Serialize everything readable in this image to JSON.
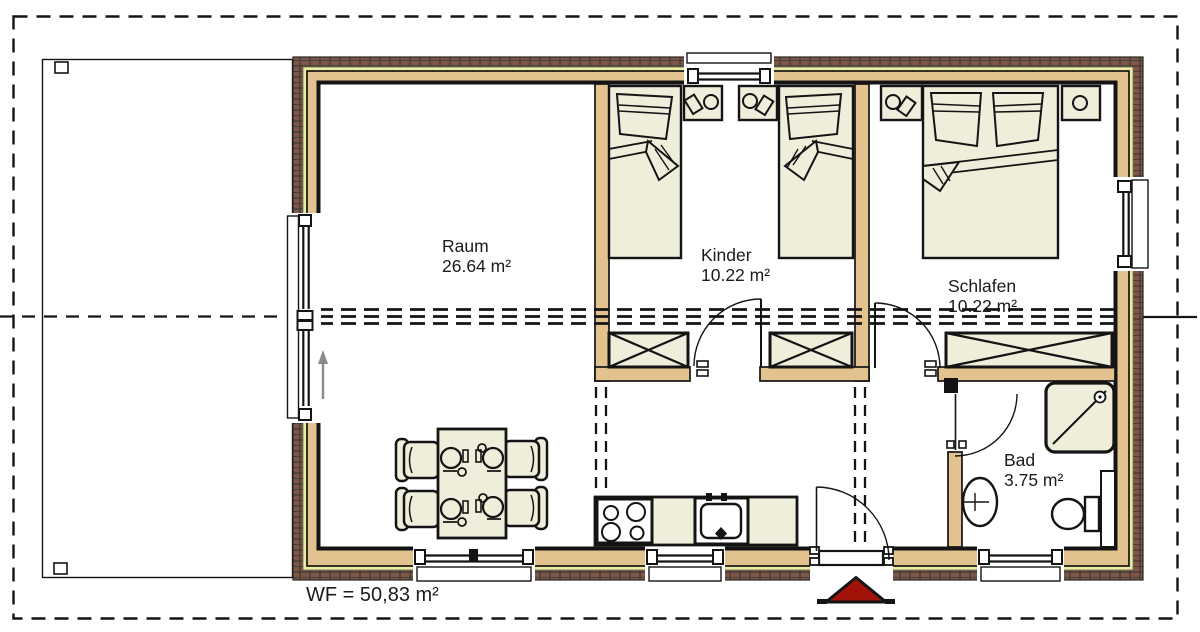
{
  "floor_plan": {
    "rooms": [
      {
        "id": "raum",
        "name": "Raum",
        "area": "26.64 m²"
      },
      {
        "id": "kinder",
        "name": "Kinder",
        "area": "10.22 m²"
      },
      {
        "id": "schlafen",
        "name": "Schlafen",
        "area": "10.22 m²"
      },
      {
        "id": "bad",
        "name": "Bad",
        "area": "3.75 m²"
      }
    ],
    "total_area_label": "WF = 50,83 m²",
    "colors": {
      "wall_wood": "#e2c28e",
      "wall_insulation": "#eceba2",
      "brick": "#7d5648",
      "brick_mortar": "#474038",
      "furniture_fill": "#efeeda",
      "entrance_marker_red": "#a31208",
      "line": "#141414"
    }
  }
}
